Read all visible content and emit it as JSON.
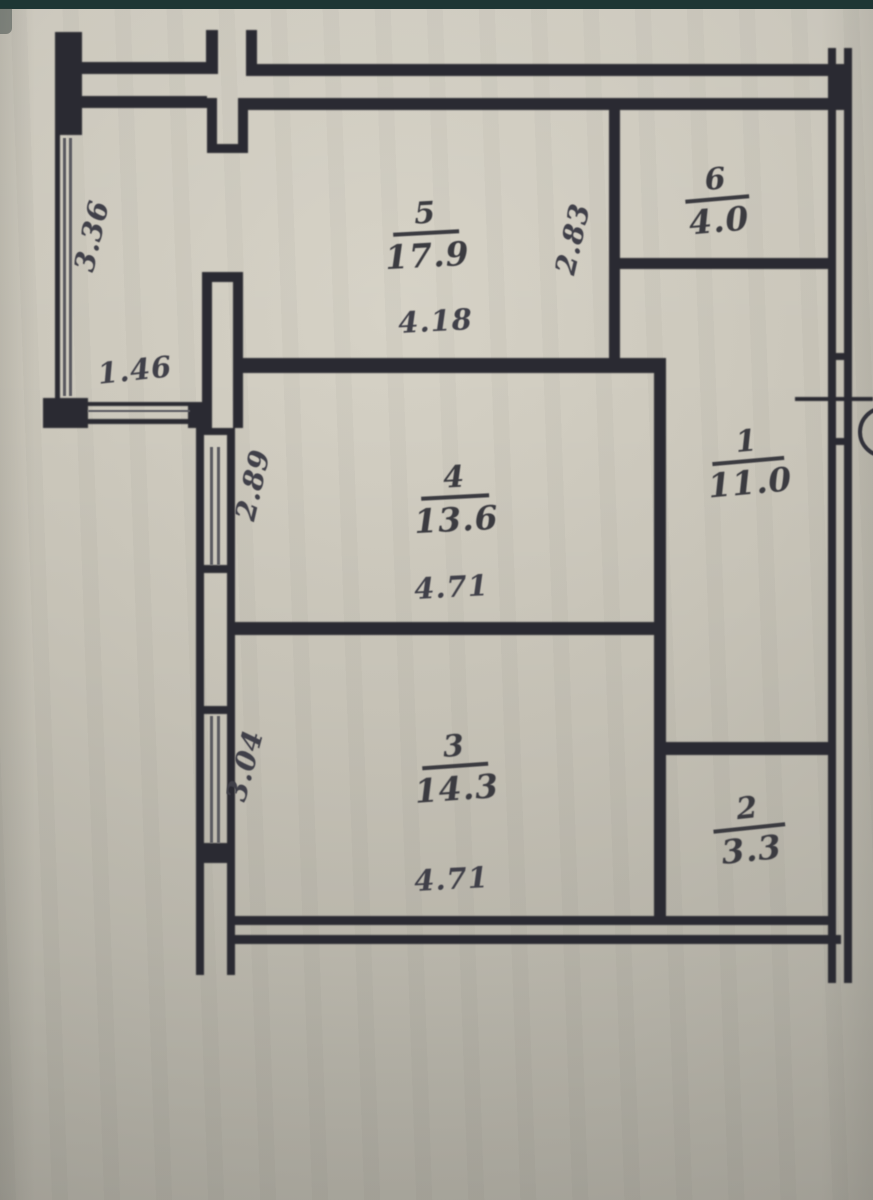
{
  "document": {
    "type": "scanned apartment floor plan",
    "style": "BTI technical drawing photo"
  },
  "rooms": {
    "r5": {
      "number": "5",
      "area": "17.9"
    },
    "r6": {
      "number": "6",
      "area": "4.0"
    },
    "r4": {
      "number": "4",
      "area": "13.6"
    },
    "r1": {
      "number": "1",
      "area": "11.0"
    },
    "r3": {
      "number": "3",
      "area": "14.3"
    },
    "r2": {
      "number": "2",
      "area": "3.3"
    }
  },
  "dimensions": {
    "balcony_height": "3.36",
    "balcony_width": "1.46",
    "room5_width": "4.18",
    "room5_height": "2.83",
    "room4_height": "2.89",
    "room4_width": "4.71",
    "room3_height": "3.04",
    "room3_width": "4.71"
  },
  "colors": {
    "paper": "#cac6ba",
    "ink": "#2b2b31",
    "text": "#3a3a41",
    "top_bar": "#1e3634",
    "smudge": "#2c3a38"
  }
}
